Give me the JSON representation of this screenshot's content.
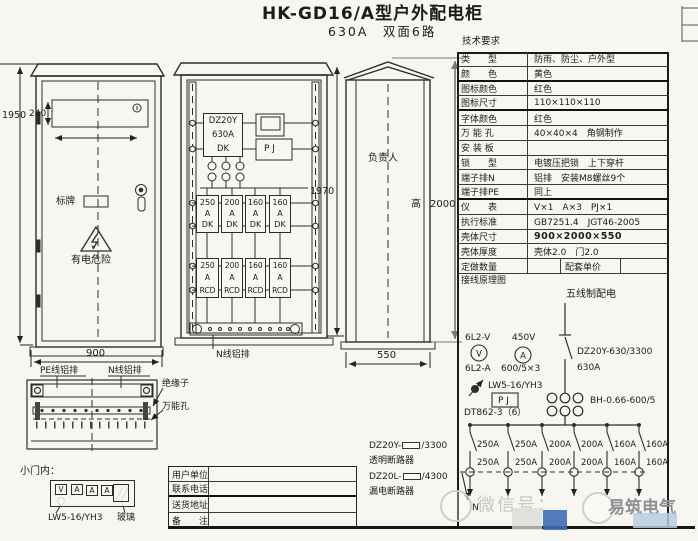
{
  "header": {
    "title": "HK-GD16/A型户外配电柜",
    "subtitle": "630A　双面6路"
  },
  "spec": {
    "header": "技术要求",
    "rows": [
      {
        "l": "类　　型",
        "v": "防雨、防尘、户外型"
      },
      {
        "l": "颜　　色",
        "v": "黄色"
      },
      {
        "l": "图标颜色",
        "v": "红色"
      },
      {
        "l": "图标尺寸",
        "v": "110×110×110"
      },
      {
        "l": "字体颜色",
        "v": "红色"
      },
      {
        "l": "万 能 孔",
        "v": "40×40×4　角钢制作"
      },
      {
        "l": "安 装 板",
        "v": ""
      },
      {
        "l": "锁　　型",
        "v": "电镀压把锁　上下穿杆"
      },
      {
        "l": "端子排N",
        "v": "铝排　安装M8螺丝9个"
      },
      {
        "l": "端子排PE",
        "v": "同上"
      },
      {
        "l": "仪　　表",
        "v": "V×1　A×3　PJ×1"
      },
      {
        "l": "执行标准",
        "v": "GB7251.4　JGT46-2005"
      },
      {
        "l": "壳体尺寸",
        "v": "900×2000×550"
      },
      {
        "l": "壳体厚度",
        "v": "壳体2.0　门2.0"
      }
    ],
    "order": {
      "label": "定做数量",
      "price": "配套单价"
    },
    "schematic_label": "接线原理图"
  },
  "schematic": {
    "title": "五线制配电",
    "voltmeter_model": "6L2-V",
    "voltmeter_symbol": "V",
    "voltage": "450V",
    "ammeter_symbol": "A",
    "ammeter_model": "6L2-A",
    "ct_ratio": "600/5×3",
    "switch_model": "LW5-16/YH3",
    "meter_box": "P J",
    "meter_model": "DT862-3（6）",
    "main_breaker": "DZ20Y-630/3300",
    "main_amp": "630A",
    "ct_model": "BH-0.66-600/5",
    "branch_top": [
      "250A",
      "250A",
      "200A",
      "200A",
      "160A",
      "160A"
    ],
    "branch_bottom": [
      "250A",
      "250A",
      "200A",
      "200A",
      "160A",
      "160A"
    ],
    "neutral": "N"
  },
  "front": {
    "d1950": "1950",
    "d240": "240",
    "d900": "900",
    "nameplate": "标牌",
    "warning": "有电危险"
  },
  "mid": {
    "box1": "DZ20Y",
    "box2": "630A",
    "box3": "DK",
    "pj": "P J",
    "d1970": "1970",
    "nbus": "N线铝排",
    "dk": [
      {
        "a": "250",
        "u": "A",
        "t": "DK"
      },
      {
        "a": "200",
        "u": "A",
        "t": "DK"
      },
      {
        "a": "160",
        "u": "A",
        "t": "DK"
      },
      {
        "a": "160",
        "u": "A",
        "t": "DK"
      }
    ],
    "rcd": [
      {
        "a": "250",
        "u": "A",
        "t": "RCD"
      },
      {
        "a": "200",
        "u": "A",
        "t": "RCD"
      },
      {
        "a": "160",
        "u": "A",
        "t": "RCD"
      },
      {
        "a": "160",
        "u": "A",
        "t": "RCD"
      }
    ]
  },
  "side": {
    "owner": "负责人",
    "h": "高",
    "hval": "2000",
    "d550": "550"
  },
  "bus": {
    "pe": "PE线铝排",
    "n": "N线铝排",
    "ins": "绝缘子",
    "hole": "万能孔"
  },
  "door": {
    "title": "小门内：",
    "meters": [
      "V",
      "A",
      "A",
      "A"
    ],
    "sw": "LW5-16/YH3",
    "glass": "玻璃"
  },
  "info": {
    "rows": [
      {
        "l": "用户单位",
        "v": ""
      },
      {
        "l": "联系电话",
        "v": ""
      },
      {
        "l": "送货地址",
        "v": ""
      },
      {
        "l": "备　　注",
        "v": ""
      }
    ]
  },
  "legend": {
    "m1": "DZ20Y-",
    "s1": "/3300",
    "n1": "透明断路器",
    "m2": "DZ20L-",
    "s2": "/4300",
    "n2": "漏电断路器"
  },
  "watermark": {
    "wx": "微信号：",
    "brand": "易筑电气"
  }
}
